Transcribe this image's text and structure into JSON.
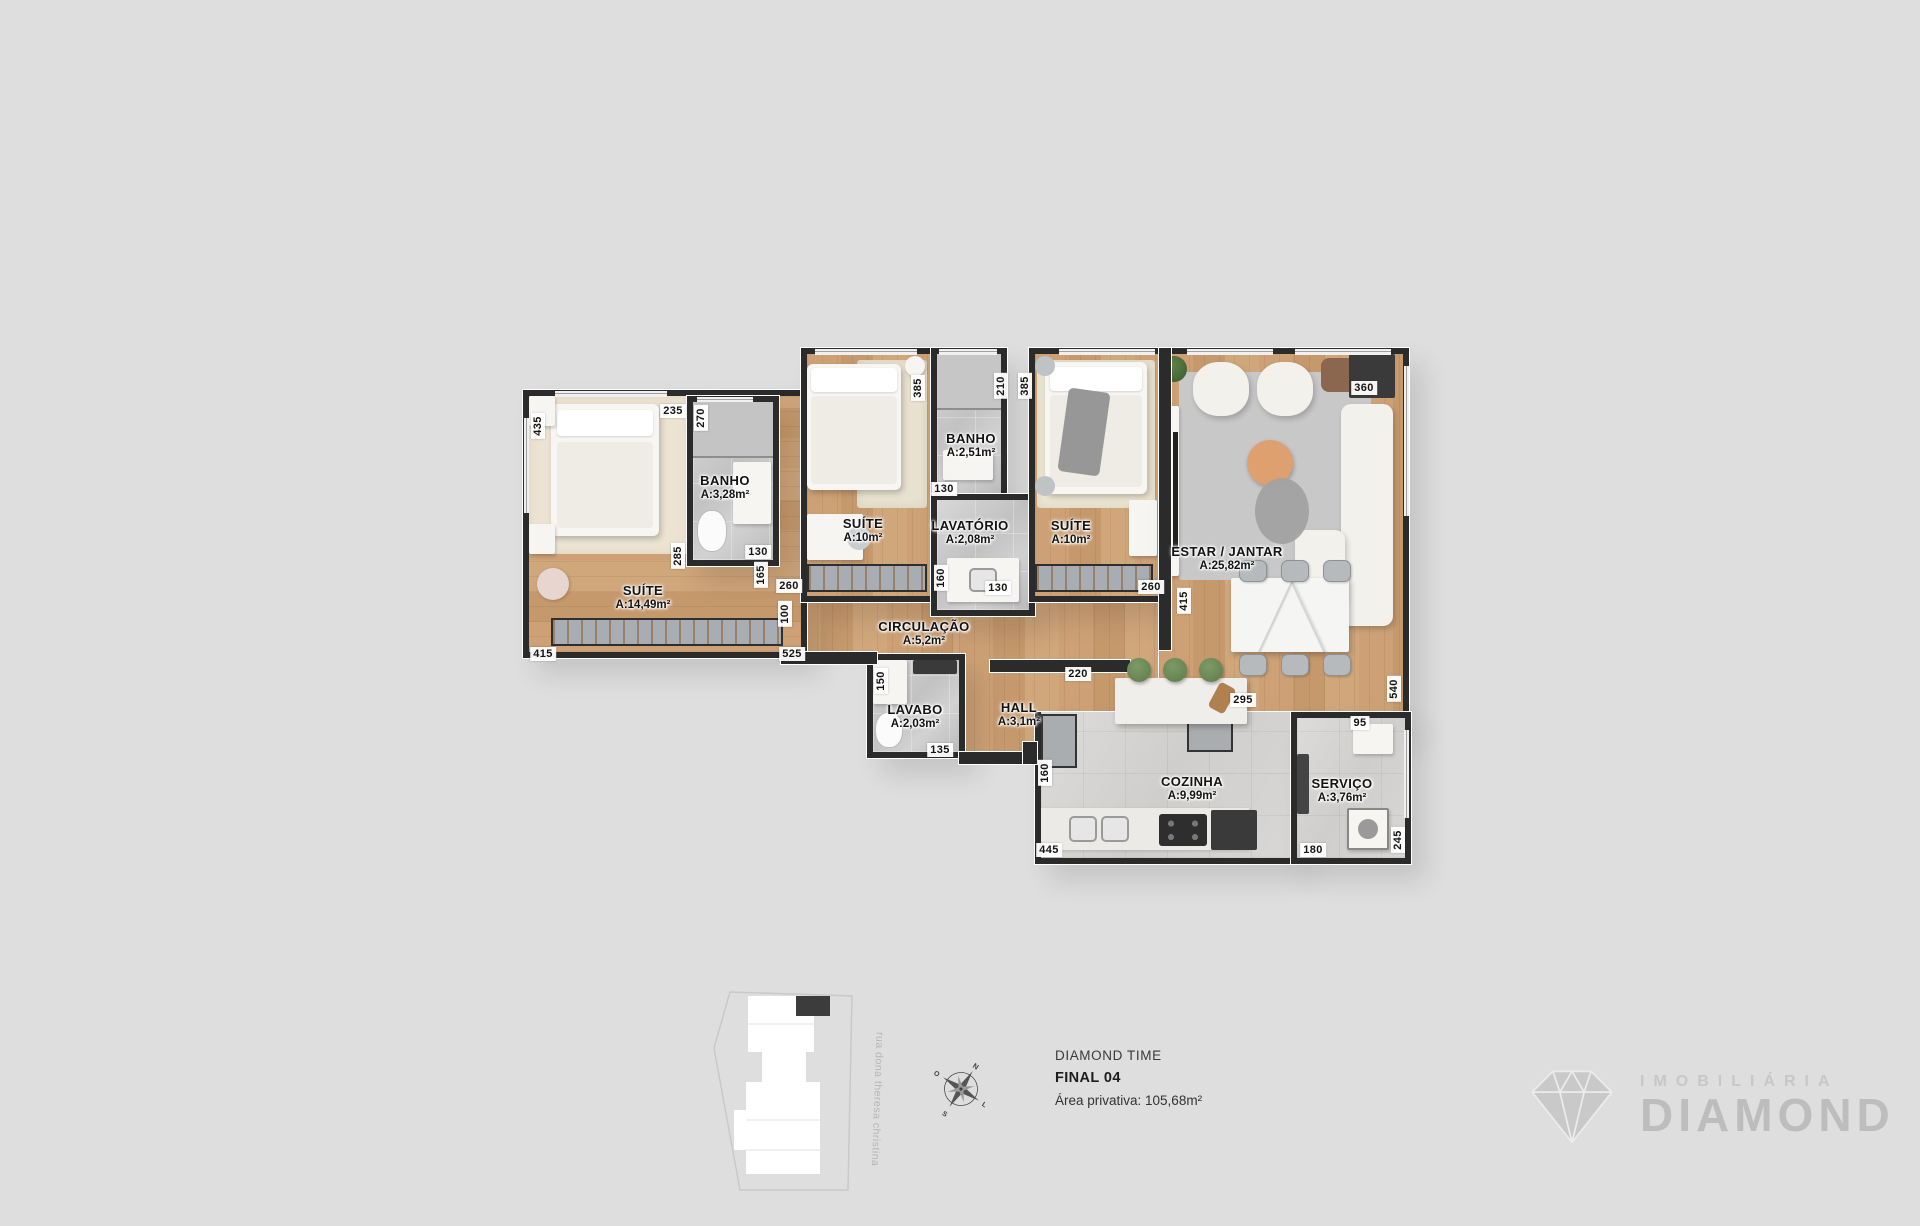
{
  "colors": {
    "background": "#dfdede",
    "wall": "#2b2b2b",
    "wood_floor": "#cda175",
    "tile_floor": "#cfcfcf",
    "stool_green": "#6d8a58"
  },
  "plan": {
    "rooms": [
      {
        "name": "SUÍTE",
        "area": "A:14,49m²"
      },
      {
        "name": "BANHO",
        "area": "A:3,28m²"
      },
      {
        "name": "SUÍTE",
        "area": "A:10m²"
      },
      {
        "name": "BANHO",
        "area": "A:2,51m²"
      },
      {
        "name": "LAVATÓRIO",
        "area": "A:2,08m²"
      },
      {
        "name": "SUÍTE",
        "area": "A:10m²"
      },
      {
        "name": "ESTAR / JANTAR",
        "area": "A:25,82m²"
      },
      {
        "name": "CIRCULAÇÃO",
        "area": "A:5,2m²"
      },
      {
        "name": "LAVABO",
        "area": "A:2,03m²"
      },
      {
        "name": "HALL",
        "area": "A:3,1m²"
      },
      {
        "name": "COZINHA",
        "area": "A:9,99m²"
      },
      {
        "name": "SERVIÇO",
        "area": "A:3,76m²"
      }
    ],
    "dimensions": [
      {
        "value": "435",
        "x": 23,
        "y": 78,
        "vertical": true
      },
      {
        "value": "235",
        "x": 158,
        "y": 63,
        "vertical": false
      },
      {
        "value": "270",
        "x": 186,
        "y": 70,
        "vertical": true
      },
      {
        "value": "285",
        "x": 163,
        "y": 208,
        "vertical": true
      },
      {
        "value": "130",
        "x": 243,
        "y": 204,
        "vertical": false
      },
      {
        "value": "165",
        "x": 246,
        "y": 227,
        "vertical": true
      },
      {
        "value": "260",
        "x": 274,
        "y": 238,
        "vertical": false
      },
      {
        "value": "100",
        "x": 270,
        "y": 266,
        "vertical": true
      },
      {
        "value": "415",
        "x": 28,
        "y": 306,
        "vertical": false
      },
      {
        "value": "525",
        "x": 277,
        "y": 306,
        "vertical": false
      },
      {
        "value": "385",
        "x": 403,
        "y": 40,
        "vertical": true
      },
      {
        "value": "210",
        "x": 486,
        "y": 38,
        "vertical": true
      },
      {
        "value": "385",
        "x": 510,
        "y": 38,
        "vertical": true
      },
      {
        "value": "130",
        "x": 429,
        "y": 141,
        "vertical": false
      },
      {
        "value": "160",
        "x": 426,
        "y": 230,
        "vertical": true
      },
      {
        "value": "130",
        "x": 483,
        "y": 240,
        "vertical": false
      },
      {
        "value": "260",
        "x": 636,
        "y": 239,
        "vertical": false
      },
      {
        "value": "415",
        "x": 669,
        "y": 253,
        "vertical": true
      },
      {
        "value": "360",
        "x": 849,
        "y": 40,
        "vertical": false
      },
      {
        "value": "220",
        "x": 563,
        "y": 326,
        "vertical": false
      },
      {
        "value": "150",
        "x": 366,
        "y": 333,
        "vertical": true
      },
      {
        "value": "135",
        "x": 425,
        "y": 402,
        "vertical": false
      },
      {
        "value": "295",
        "x": 728,
        "y": 352,
        "vertical": false
      },
      {
        "value": "540",
        "x": 879,
        "y": 341,
        "vertical": true
      },
      {
        "value": "95",
        "x": 845,
        "y": 375,
        "vertical": false
      },
      {
        "value": "160",
        "x": 530,
        "y": 425,
        "vertical": true
      },
      {
        "value": "445",
        "x": 534,
        "y": 502,
        "vertical": false
      },
      {
        "value": "180",
        "x": 798,
        "y": 502,
        "vertical": false
      },
      {
        "value": "245",
        "x": 883,
        "y": 492,
        "vertical": true
      }
    ]
  },
  "site_plan": {
    "street": "rua dona theresa christina"
  },
  "compass": {
    "north": "N",
    "east": "L",
    "south": "S",
    "west": "O"
  },
  "info": {
    "project": "DIAMOND TIME",
    "unit": "FINAL 04",
    "private_area": "Área privativa: 105,68m²"
  },
  "brand": {
    "tagline": "IMOBILIÁRIA",
    "name": "DIAMOND"
  }
}
